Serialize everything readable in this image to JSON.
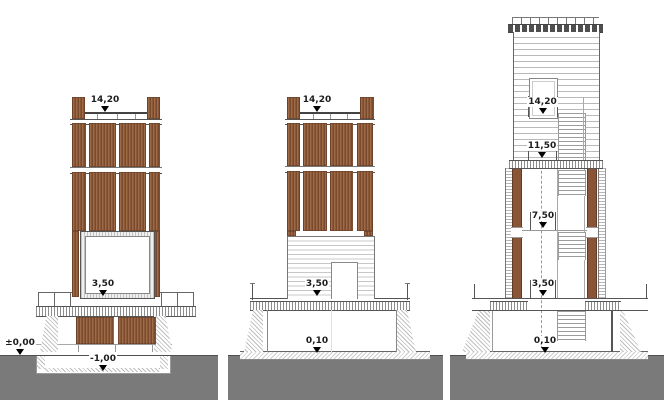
{
  "colors": {
    "wood_slats": "#8a5738",
    "ground": "#7a7a7a",
    "linework": "#555555"
  },
  "drawings": {
    "left": {
      "levels": {
        "parapet": "14,20",
        "floor": "3,50",
        "ground": "±0,00",
        "pit": "-1,00"
      }
    },
    "center": {
      "levels": {
        "parapet": "14,20",
        "floor": "3,50",
        "base": "0,10"
      }
    },
    "right": {
      "levels": {
        "parapet": "14,20",
        "roof": "11,50",
        "upper": "7,50",
        "floor": "3,50",
        "base": "0,10"
      }
    }
  }
}
